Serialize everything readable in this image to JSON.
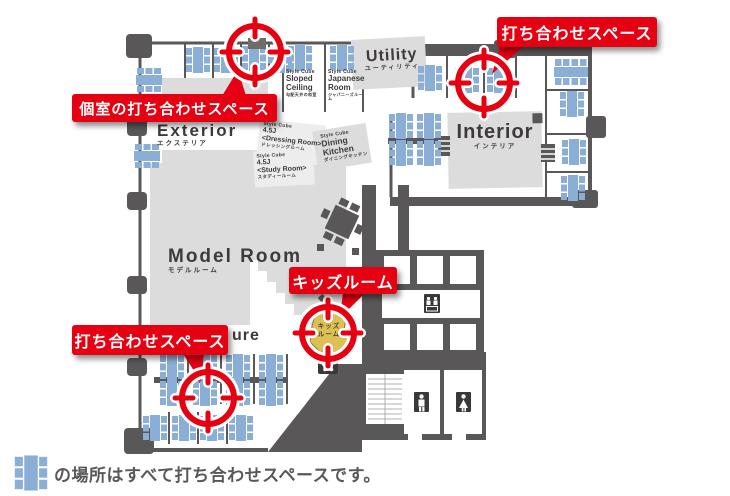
{
  "palette": {
    "red": "#e50012",
    "wall": "#595757",
    "room_fill": "#dcdcdc",
    "table_blue": "#8aaed6",
    "kids_yellow": "#dcbf55",
    "text_dark": "#3e3a39"
  },
  "callouts": {
    "meeting_top_right": "打ち合わせスペース",
    "private_meeting": "個室の打ち合わせスペース",
    "kids_room": "キッズルーム",
    "meeting_bottom_left": "打ち合わせスペース"
  },
  "rooms": {
    "utility": {
      "en": "Utility",
      "ja": "ユーティリティ"
    },
    "exterior": {
      "en": "Exterior",
      "ja": "エクステリア"
    },
    "interior": {
      "en": "Interior",
      "ja": "インテリア"
    },
    "model_room": {
      "en": "Model Room",
      "ja": "モデルルーム"
    },
    "furniture_partial": "ure",
    "sloped_ceiling": {
      "brand": "Style Cube",
      "en": "Sloped\nCeiling",
      "ja": "勾配天井の和室"
    },
    "japanese_room": {
      "brand": "Style Cube",
      "en": "Japanese\nRoom",
      "ja": "ジャパニーズルーム"
    },
    "dressing_room": {
      "brand": "Style Cube",
      "size": "4.5J",
      "en": "<Dressing Room>",
      "ja": "ドレッシングルーム"
    },
    "study_room": {
      "brand": "Style Cube",
      "size": "4.5J",
      "en": "<Study Room>",
      "ja": "スタディールーム"
    },
    "dining_kitchen": {
      "brand": "Style Cube",
      "en": "Dining\nKitchen",
      "ja": "ダイニングキッチン"
    },
    "kids": {
      "ja": "キッズ\nルーム"
    }
  },
  "caption": {
    "text": "の場所はすべて打ち合わせスペースです。"
  }
}
